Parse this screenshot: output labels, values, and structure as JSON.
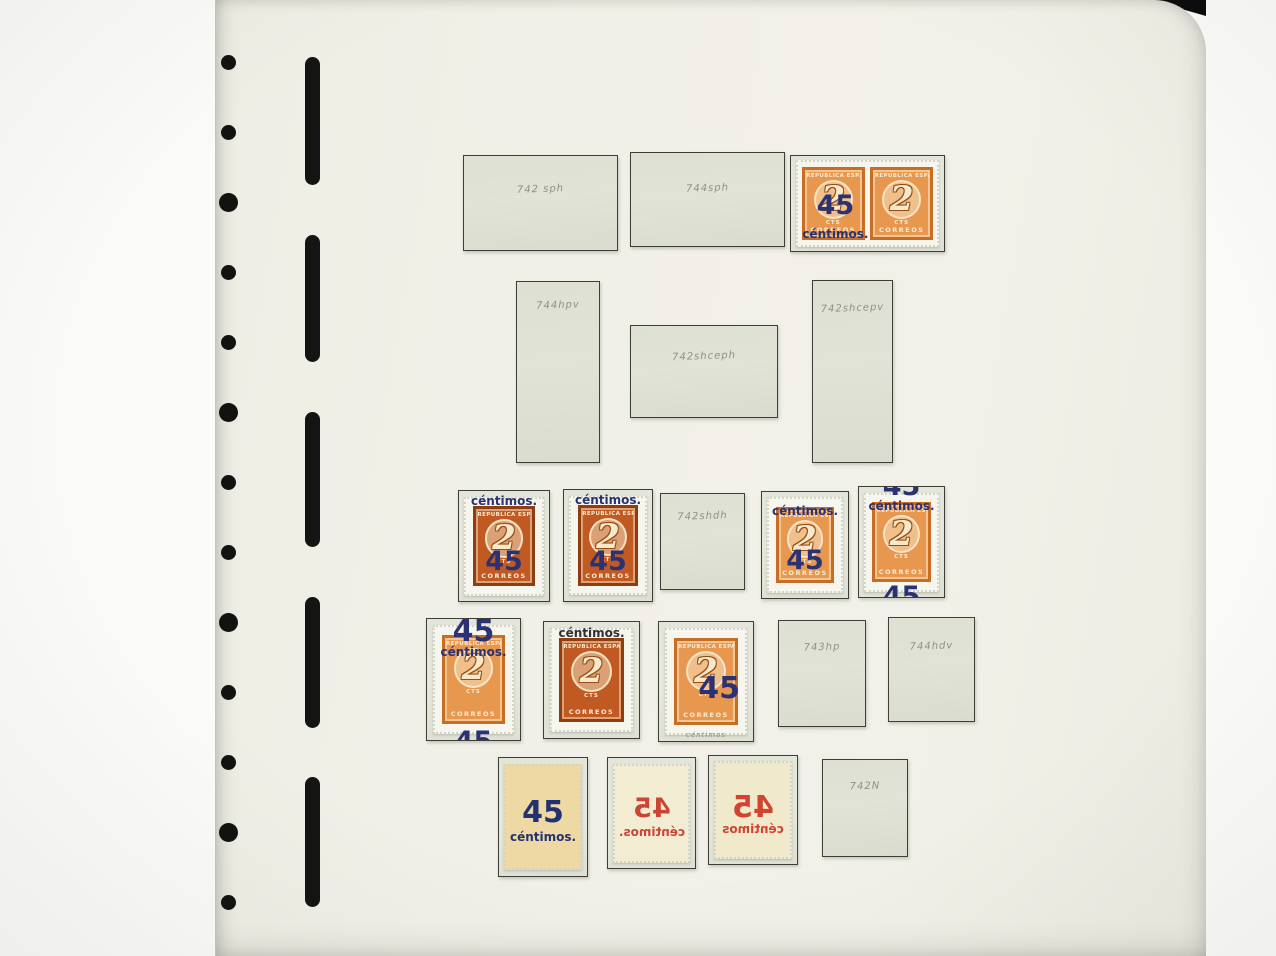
{
  "binder": {
    "brand_top": "Lighthouse",
    "brand_bottom": "Leuchtturm",
    "hole_count": 13,
    "slot_count": 5
  },
  "page": {
    "title": "ESPAÑA",
    "page_number": "715",
    "stamp_base": {
      "top": "REPUBLICA ESPAÑOLA",
      "numeral": "2",
      "unit": "CTS",
      "bottom": "CORREOS"
    },
    "colors": {
      "page_background": "#f1f0e8",
      "mount_gray": "#dde0d3",
      "stamp_orange": "#e8974f",
      "stamp_red_brown": "#c05a22",
      "overprint_blue": "#2a3273",
      "overprint_red": "#cf4837",
      "overprint_black": "#2f2f35",
      "pencil_gray": "#85877b"
    },
    "items": [
      {
        "id": "r1m1",
        "kind": "mount",
        "annotation": "742 sph"
      },
      {
        "id": "r1m2",
        "kind": "mount",
        "annotation": "744sph"
      },
      {
        "id": "r1pair",
        "kind": "pair",
        "variant": "orange",
        "overprint": {
          "color": "#2a3273",
          "elements": [
            {
              "text": "45",
              "kind": "num",
              "slot": "s-pn"
            },
            {
              "text": "céntimos.",
              "kind": "word",
              "slot": "s-pw"
            }
          ]
        }
      },
      {
        "id": "r2m1",
        "kind": "mount",
        "annotation": "744hpv"
      },
      {
        "id": "r2m2",
        "kind": "mount",
        "annotation": "742shceph"
      },
      {
        "id": "r2m3",
        "kind": "mount",
        "annotation": "742shcepv"
      },
      {
        "id": "r3s1",
        "kind": "stamp",
        "variant": "red",
        "overprint": {
          "color": "#2a3273",
          "elements": [
            {
              "text": "céntimos.",
              "kind": "word",
              "slot": "s-w-top"
            },
            {
              "text": "45",
              "kind": "num",
              "slot": "s-n-low"
            }
          ]
        }
      },
      {
        "id": "r3s2",
        "kind": "stamp",
        "variant": "red",
        "overprint": {
          "color": "#2a3273",
          "elements": [
            {
              "text": "céntimos.",
              "kind": "word",
              "slot": "s-w-top"
            },
            {
              "text": "45",
              "kind": "num",
              "slot": "s-n-low"
            }
          ]
        }
      },
      {
        "id": "r3m1",
        "kind": "mount",
        "annotation": "742shdh"
      },
      {
        "id": "r3s3",
        "kind": "stamp",
        "variant": "orange",
        "overprint": {
          "color": "#2a3273",
          "elements": [
            {
              "text": "céntimos.",
              "kind": "word",
              "slot": "s-w-upper"
            },
            {
              "text": "45",
              "kind": "num",
              "slot": "s-n-low"
            }
          ]
        }
      },
      {
        "id": "r3s4",
        "kind": "stamp",
        "variant": "orange",
        "overprint": {
          "color": "#2a3273",
          "elements": [
            {
              "text": "45",
              "kind": "num",
              "slot": "s-n-topclip"
            },
            {
              "text": "céntimos.",
              "kind": "word",
              "slot": "s-w-upper"
            },
            {
              "text": "45",
              "kind": "num",
              "slot": "s-n-botclip"
            }
          ]
        }
      },
      {
        "id": "r4s1",
        "kind": "stamp",
        "variant": "orange",
        "overprint": {
          "color": "#2a3273",
          "elements": [
            {
              "text": "45",
              "kind": "num",
              "slot": "s-n-top",
              "big": true
            },
            {
              "text": "céntimos.",
              "kind": "word",
              "slot": "s-w-under-top"
            },
            {
              "text": "45",
              "kind": "num",
              "slot": "s-n-botclip"
            }
          ]
        }
      },
      {
        "id": "r4s2",
        "kind": "stamp",
        "variant": "red",
        "overprint": {
          "color": "#2f2f35",
          "elements": [
            {
              "text": "céntimos.",
              "kind": "word",
              "slot": "s-w-top"
            }
          ]
        }
      },
      {
        "id": "r4s3",
        "kind": "stamp",
        "variant": "orange",
        "overprint": {
          "color": "#2a3273",
          "elements": [
            {
              "text": "45",
              "kind": "num",
              "slot": "s-n-right",
              "big": true
            },
            {
              "text": "céntimos",
              "kind": "word",
              "slot": "s-w-pencil",
              "pencil": true,
              "color": "#6d6f78"
            }
          ]
        }
      },
      {
        "id": "r4m1",
        "kind": "mount",
        "annotation": "743hp"
      },
      {
        "id": "r4m2",
        "kind": "mount",
        "annotation": "744hdv"
      },
      {
        "id": "r5b1",
        "kind": "back",
        "tint": "#eed9a4",
        "mirrored": false,
        "overprint": {
          "color": "#223271",
          "elements": [
            {
              "text": "45",
              "kind": "num",
              "slot": "s-n-center",
              "big": true
            },
            {
              "text": "céntimos.",
              "kind": "word",
              "slot": "s-w-center"
            }
          ]
        }
      },
      {
        "id": "r5b2",
        "kind": "back",
        "tint": "#f2ecd2",
        "mirrored": true,
        "overprint": {
          "color": "#cc4434",
          "elements": [
            {
              "text": "45",
              "kind": "num",
              "slot": "s-n-center"
            },
            {
              "text": "céntimos.",
              "kind": "word",
              "slot": "s-w-center"
            }
          ]
        }
      },
      {
        "id": "r5b3",
        "kind": "back",
        "tint": "#f0e9cc",
        "mirrored": true,
        "overprint": {
          "color": "#d24330",
          "elements": [
            {
              "text": "45",
              "kind": "num",
              "slot": "s-n-center",
              "big": true
            },
            {
              "text": "céntimos",
              "kind": "word",
              "slot": "s-w-center"
            }
          ]
        }
      },
      {
        "id": "r5m1",
        "kind": "mount",
        "annotation": "742N"
      }
    ]
  }
}
